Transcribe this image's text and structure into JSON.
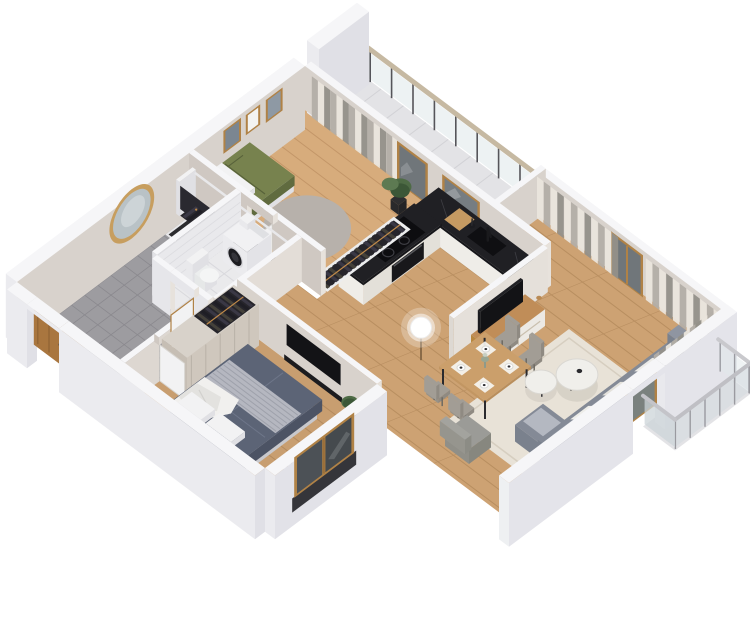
{
  "meta": {
    "description": "3D isometric cutaway render of a one-bedroom apartment floor plan, white background, no text",
    "background": "#ffffff"
  },
  "palette": {
    "bg": "#ffffff",
    "wallTop": "#f6f6f8",
    "extFaceR": "#e0e0e6",
    "extFaceL": "#ebebef",
    "intWarm": "#d8d2cc",
    "intWarm2": "#cfc8c2",
    "endCap": "#e7e2dc",
    "woodFloor1": "#d7ac7c",
    "woodLine1": "#c39668",
    "woodFloor2": "#cda273",
    "woodLine2": "#b88e60",
    "woodFloor3": "#c89e70",
    "woodLine3": "#b38a5e",
    "tileKitchen": "#d8d8db",
    "tileKitchenLine": "#c5c5ca",
    "tileBath": "#eaeaec",
    "tileBathLine": "#d9d9dd",
    "tileHall": "#9d9ca0",
    "tileHallLine": "#8a898e",
    "tileBalc": "#e3e3e6",
    "tileBalcLine": "#d2d2d6",
    "counterTop": "#202024",
    "counterFace": "#16161a",
    "cabinet": "#efede8",
    "cabinetShade": "#e3e0d9",
    "applianceDark": "#18181b",
    "wood": "#b08246",
    "woodDark": "#9a6f3a",
    "doorBrown": "#a9763f",
    "glassDark": "#70767a",
    "glassWin": "#454a4e",
    "curtainCream": "#eae5dc",
    "curtainGray": "#b3aea7",
    "curtainDark": "#949089",
    "railGlass": "#dfe7ea",
    "railPost": "#55555a",
    "railTop": "#c6b9a2",
    "bedGreen": "#77824e",
    "bedGreenDark": "#606b3f",
    "plant": "#4e6b45",
    "plantDark": "#3c5737",
    "white": "#f2f2f3",
    "whiteShade": "#e0e0e4",
    "bedBlueTop": "#5c6476",
    "bedBlueX": "#4c5364",
    "bedBlueY": "#525a6c",
    "bedBlueFold": "#6e7689",
    "sofaTop": "#848a96",
    "sofaX": "#6f7582",
    "sofaY": "#7a818d",
    "sofaBack": "#8f95a1",
    "rugLiving": "#e8e2d7",
    "rugLivingLine": "#d6cec0",
    "rugRound": "#b7b1ab",
    "chair": "#a29d95",
    "chairDark": "#8f8a82",
    "marble": "#f0efeb",
    "marbleShade": "#dad8d3",
    "clothesDark": "#26252b",
    "clothesMid": "#3a3845",
    "clothesLight": "#44413a",
    "brass": "#c08a4a",
    "mirrorGlass": "#b9c2c6",
    "mirrorGold": "#c79e5f",
    "tv": "#131316",
    "matDark": "#2c2c2f",
    "throwStripe": "#b9bcc4",
    "throwLine": "#9ea1ab"
  },
  "rooms": [
    {
      "id": "balcony-top",
      "label": "top balcony",
      "features": [
        "glass-railing",
        "tall-parapet-wall",
        "tile-floor"
      ]
    },
    {
      "id": "bedroom-small",
      "label": "small bedroom",
      "floor": "wood",
      "furniture": [
        "single-bed-green",
        "white-pillow",
        "picture-frames-x3",
        "potted-plant",
        "round-rug",
        "open-wardrobe-clothes",
        "curtains",
        "balcony-door"
      ]
    },
    {
      "id": "kitchen",
      "label": "kitchen",
      "floor": "gray-tile",
      "furniture": [
        "l-counter-black-marble",
        "cooktop-4-rings",
        "oven",
        "sink",
        "black-faucet",
        "cutting-board",
        "utensil-cup",
        "window-over-sink"
      ]
    },
    {
      "id": "living-room",
      "label": "living room",
      "floor": "wood-planks",
      "furniture": [
        "tv-stand-wood-white",
        "flat-tv",
        "globe-floor-lamp",
        "dining-table-4-chairs",
        "place-settings",
        "flower-vase",
        "coffee-tables-x2-marble",
        "area-rug-cream",
        "corner-sofa-gray",
        "white-cushions",
        "armchair-gray",
        "curtain-wall",
        "balcony-door",
        "side-curtains"
      ]
    },
    {
      "id": "hallway",
      "label": "entry hall",
      "floor": "dark-tile",
      "furniture": [
        "coat-rack-dark-clothes",
        "round-mirror-gold",
        "entrance-door-brown",
        "doormat",
        "dark-shower-mat"
      ]
    },
    {
      "id": "bathroom",
      "label": "bathroom",
      "floor": "white-tile",
      "furniture": [
        "washing-machine",
        "toilet",
        "open-door"
      ]
    },
    {
      "id": "bedroom-main",
      "label": "main bedroom",
      "floor": "wood",
      "furniture": [
        "double-bed-blue",
        "white-duvet",
        "pillows",
        "striped-throw",
        "wardrobe-open-clothes",
        "wall-tv",
        "media-ledge",
        "wood-window",
        "white-radiator",
        "plant",
        "open-door"
      ]
    },
    {
      "id": "balcony-side",
      "label": "side balcony",
      "features": [
        "glass-railing",
        "balcony-door",
        "tile-floor"
      ]
    }
  ]
}
